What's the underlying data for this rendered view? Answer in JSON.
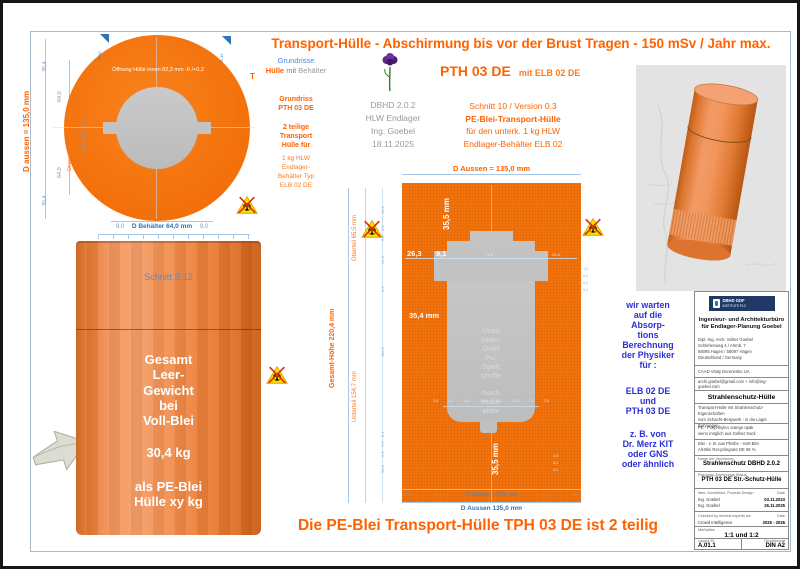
{
  "page": {
    "top_title": "Transport-Hülle - Abschirmung bis vor der Brust Tragen - 150 mSv / Jahr max.",
    "bottom_title": "Die PE-Blei Transport-Hülle TPH 03 DE ist 2 teilig"
  },
  "plan": {
    "flag_left": "S-10",
    "flag_right": "S-12",
    "opening_label": "Öffnung Hülle innen 82,3 mm -0 /+0,2",
    "d_aussen": "D aussen = 135,0 mm",
    "d_innen": "Dinnen 64,2 mm -0 / +0,2",
    "wall": "7,0 mm -0 / +0,2",
    "left_dims": [
      "35,4",
      "64,0",
      "64,0",
      "35,4"
    ],
    "bottom_left": "9,0",
    "bottom_center": "D Behälter 64,0 mm",
    "bottom_right": "9,0",
    "marker": "T"
  },
  "leftcol": {
    "l1": "Grundrisse",
    "l2a": "Hülle",
    "l2b": "mit",
    "l2c": "Behälter",
    "block1": [
      "Grundriss",
      "PTH 03 DE"
    ],
    "block2": [
      "2 teilige",
      "Transport",
      "Hülle für"
    ],
    "block3": [
      "1 kg HLW",
      "Endlager-",
      "Behälter Typ",
      "ELB 02 DE"
    ]
  },
  "center": {
    "meta": [
      "DBHD 2.0.2",
      "HLW Endlager",
      "Ing. Goebel",
      "18.11.2025"
    ],
    "title": "PTH 03 DE",
    "title_suffix": "mit ELB 02 DE",
    "sub": [
      "Schnitt 10 / Version 0.3",
      "PE-Blei-Transport-Hülle",
      "für den unterk. 1 kg HLW",
      "Endlager-Behälter ELB 02"
    ]
  },
  "section": {
    "top_dim": "D Aussen = 135,0 mm",
    "rot_upper": "35,5 mm",
    "dim_a": "26,3",
    "dim_b": "9,1",
    "dim_c": "71,6",
    "dim_d": "26,3",
    "dim_mid": "35,4 mm",
    "rot_lower": "35,5 mm",
    "gesamt": "Gesamt-Höhe  220,4 mm",
    "oberteil": "Oberteil 65,5 mm",
    "unterteil": "Unterteil 154,7 mm",
    "left_small": [
      "33,4",
      "1,9",
      "6,8",
      "24,3",
      "0,2",
      "110,3",
      "0,1",
      "7,1",
      "2,9",
      "33,4"
    ],
    "right_small_a": [
      "1,0",
      "0,2",
      "0,2",
      "0,2"
    ],
    "right_small_b": [
      "1,0",
      "0,2",
      "0,2"
    ],
    "content_upper": [
      "Uran",
      "Uran-",
      "Oxid",
      "Pu,",
      "Spalt",
      "stoffe"
    ],
    "content_lower": [
      "hoch",
      "radio",
      "aktiv"
    ],
    "small_row": [
      "2,9",
      "7,1",
      "14,5",
      "15,5",
      "0,1",
      "14,5",
      "7,1",
      "2,9"
    ],
    "b1": "35,4",
    "b2": "0,1",
    "b3": "D Behälter = 64,0 mm",
    "b4": "0,1",
    "b5": "35,4",
    "bottom_dim": "D Aussen 135,0 mm"
  },
  "cyl": {
    "label": "Schnitt S 12",
    "w1": [
      "Gesamt",
      "Leer-",
      "Gewicht",
      "bei",
      "Voll-Blei"
    ],
    "weight": "30,4 kg",
    "w2": [
      "als PE-Blei",
      "Hülle xy kg"
    ]
  },
  "note": {
    "g1": [
      "wir warten",
      "auf die",
      "Absorp-",
      "tions",
      "Berechnung",
      "der Physiker",
      "für :"
    ],
    "g2": [
      "ELB 02 DE",
      "und",
      "PTH 03 DE"
    ],
    "g3": [
      "z. B. von",
      "Dr. Merz KIT",
      "oder GNS",
      "oder ähnlich"
    ]
  },
  "tb": {
    "logo_line1": "DBHD GDF",
    "logo_line2": "INSTITUTE PLC",
    "firm": [
      "Ingenieur- und Architekturbüro",
      "für Endlager-Planung Goebel"
    ],
    "address": [
      "Dipl.-Ing. Arch. Volker Goebel",
      "Schlehenweg 4 / Ahrnb. 7",
      "58095 Hagen / 58097 Hagen",
      "Deutschland / Germany"
    ],
    "caad": "CAAD Vitaly Dorunenko UA",
    "email": "archi.goebel@gmail.com + info@ing-goebel.com",
    "heading": "Strahlenschutz-Hülle",
    "desc1": [
      "Transport-Hülle mit Strahlenschutz-Eigenschaften",
      "zum Schacht-Bergwerk - in die Lager Bohrungen"
    ],
    "desc2": [
      "PE - Polyethylen orange opak",
      "wenn möglich aus Gelber Sack"
    ],
    "desc3": [
      "Blei - z. B. aus PbSb4 - Hart-Blei",
      "Alt-Blei Recyclingrate DE 96 %."
    ],
    "name_label": "Name der Zeichnung",
    "name_value": "Strahlenschutz DBHD 2.0.2",
    "status_label": "Planungs-Zeichnungs Status",
    "status_value": "PTH 03 DE Str.-Schutz-Hülle",
    "design_label": "Idee, Architektur, Produkt-Design",
    "date_label": "Date",
    "design_r1_name": "Ing. Goebel",
    "design_r1_date": "03.11.2023",
    "design_r2_name": "Ing. Goebel",
    "design_r2_date": "26.11.2025",
    "checked_label": "Checked by several experts we",
    "checked_date_label": "Date",
    "checked_name": "Crowd Intelligence",
    "checked_date": "2025 - 2026",
    "scale_label": "Maßstäbe",
    "scale_value": "1:1 und 1:2",
    "layout_label": "Layout ID",
    "layout_value": "A.01.1",
    "print_label": "Druckformat",
    "print_value": "DIN A2"
  }
}
